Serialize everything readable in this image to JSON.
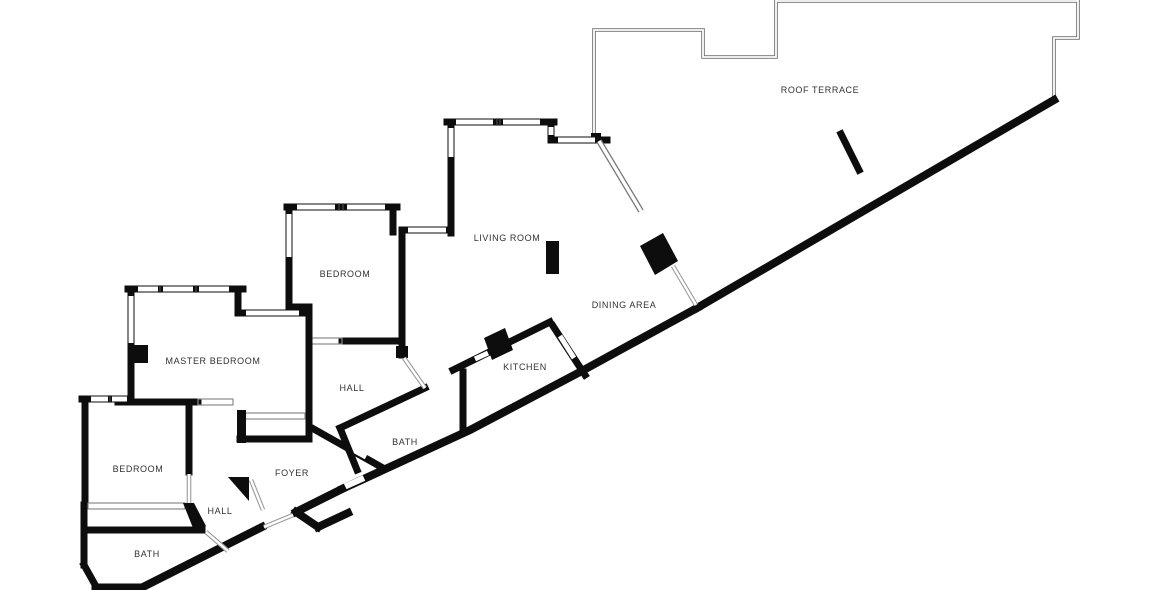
{
  "floor_plan": {
    "rooms": [
      {
        "id": "roof-terrace",
        "label": "ROOF TERRACE"
      },
      {
        "id": "living-room",
        "label": "LIVING ROOM"
      },
      {
        "id": "bedroom-mid",
        "label": "BEDROOM"
      },
      {
        "id": "master-bedroom",
        "label": "MASTER BEDROOM"
      },
      {
        "id": "hall-upper",
        "label": "HALL"
      },
      {
        "id": "kitchen",
        "label": "KITCHEN"
      },
      {
        "id": "dining-area",
        "label": "DINING AREA"
      },
      {
        "id": "bath-mid",
        "label": "BATH"
      },
      {
        "id": "bedroom-lower",
        "label": "BEDROOM"
      },
      {
        "id": "foyer",
        "label": "FOYER"
      },
      {
        "id": "hall-lower",
        "label": "HALL"
      },
      {
        "id": "bath-lower",
        "label": "BATH"
      }
    ],
    "colors": {
      "wall": "#0d0d0d",
      "background": "#ffffff",
      "parapet": "#6f6f6f",
      "label": "#323232"
    }
  }
}
